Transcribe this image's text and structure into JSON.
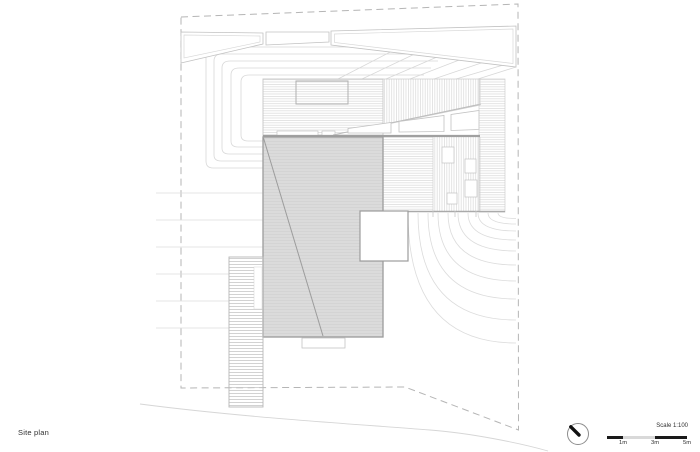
{
  "sheet": {
    "title": "Site plan"
  },
  "scale_bar": {
    "label": "Scale 1:100",
    "ticks": [
      "1m",
      "3m",
      "5m"
    ],
    "segment_colors": [
      "#1a1a1a",
      "#d9d9d9",
      "#1a1a1a"
    ]
  },
  "north_indicator": {
    "icon": "north-arrow-icon"
  },
  "colors": {
    "background": "#ffffff",
    "boundary_dash": "#b5b5b5",
    "contour_light": "#dcdcdc",
    "deck_stripe": "#d6d6d6",
    "roof_fill": "#dbdbdb",
    "roof_border": "#9c9c9c",
    "scale_black": "#1a1a1a",
    "text": "#2f2f2f"
  }
}
